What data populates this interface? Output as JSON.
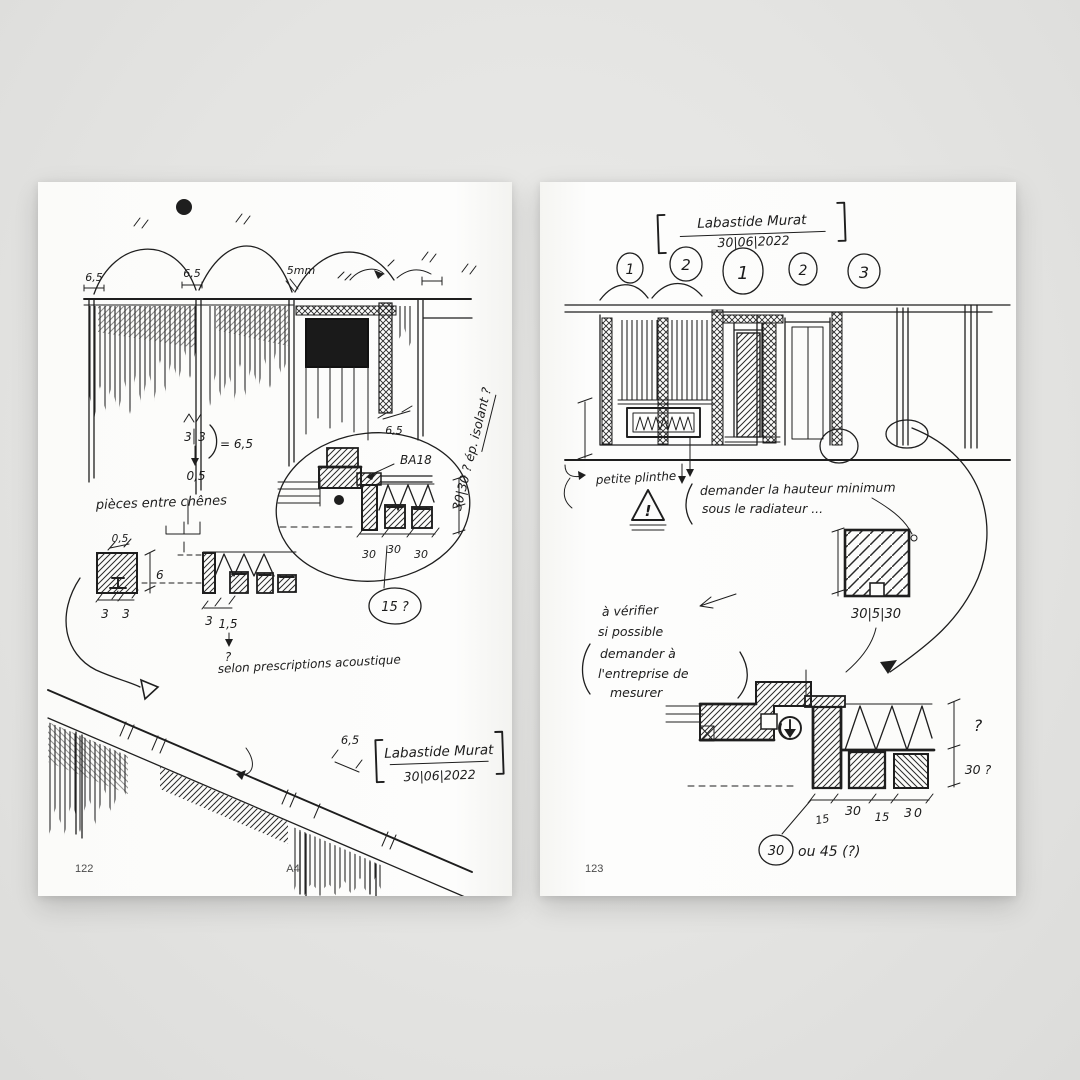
{
  "colors": {
    "background": "#e4e4e2",
    "page": "#fcfcfa",
    "ink": "#1e1e1e",
    "print": "#4a4a4a"
  },
  "left_page": {
    "footer": {
      "page_number": "122",
      "format_label": "A4"
    },
    "stamp": {
      "name": "Labastide Murat",
      "date": "30|06|2022"
    },
    "top_elevation": {
      "dim1": "6,5",
      "dim2": "6,5",
      "dim3": "5mm",
      "dim4": "6,5"
    },
    "calc_note": {
      "frac_top": "3",
      "frac_bottom": "3",
      "equals": "= 6,5",
      "result": "0,5"
    },
    "pieces_note": "pièces entre chênes",
    "module_detail": {
      "dim_05": "0,5",
      "dim_6": "6",
      "dims_a": [
        "3",
        "3"
      ],
      "dims_b": [
        "3",
        "1,5"
      ],
      "question_mark": "?",
      "acoustic_note": "selon prescriptions acoustique"
    },
    "oval_detail": {
      "label_ba18": "BA18",
      "dims_30": [
        "30",
        "30",
        "30"
      ],
      "circled_question": "15 ?",
      "rotated_note": "30|30 ? ép. isolant ?"
    },
    "perspective": {
      "dim": "6,5"
    }
  },
  "right_page": {
    "footer": {
      "page_number": "123"
    },
    "stamp": {
      "name": "Labastide Murat",
      "date": "30|06|2022"
    },
    "circled_numbers": [
      "1",
      "2",
      "1",
      "2",
      "3"
    ],
    "elevation_notes": {
      "plinthe": "petite plinthe",
      "warning_mark": "!",
      "demander_line1": "demander la hauteur minimum",
      "demander_line2": "sous le radiateur ...",
      "square_dims": "30|5|30"
    },
    "verify_note": {
      "lines": [
        "à vérifier",
        "si possible",
        "demander à",
        "l'entreprise de",
        "mesurer"
      ]
    },
    "bottom_detail": {
      "dims": [
        "15",
        "30",
        "15",
        "30"
      ],
      "circled_value": "30",
      "circled_suffix": "ou 45 (?)",
      "question_top": "?",
      "question_right": "30 ?"
    }
  }
}
